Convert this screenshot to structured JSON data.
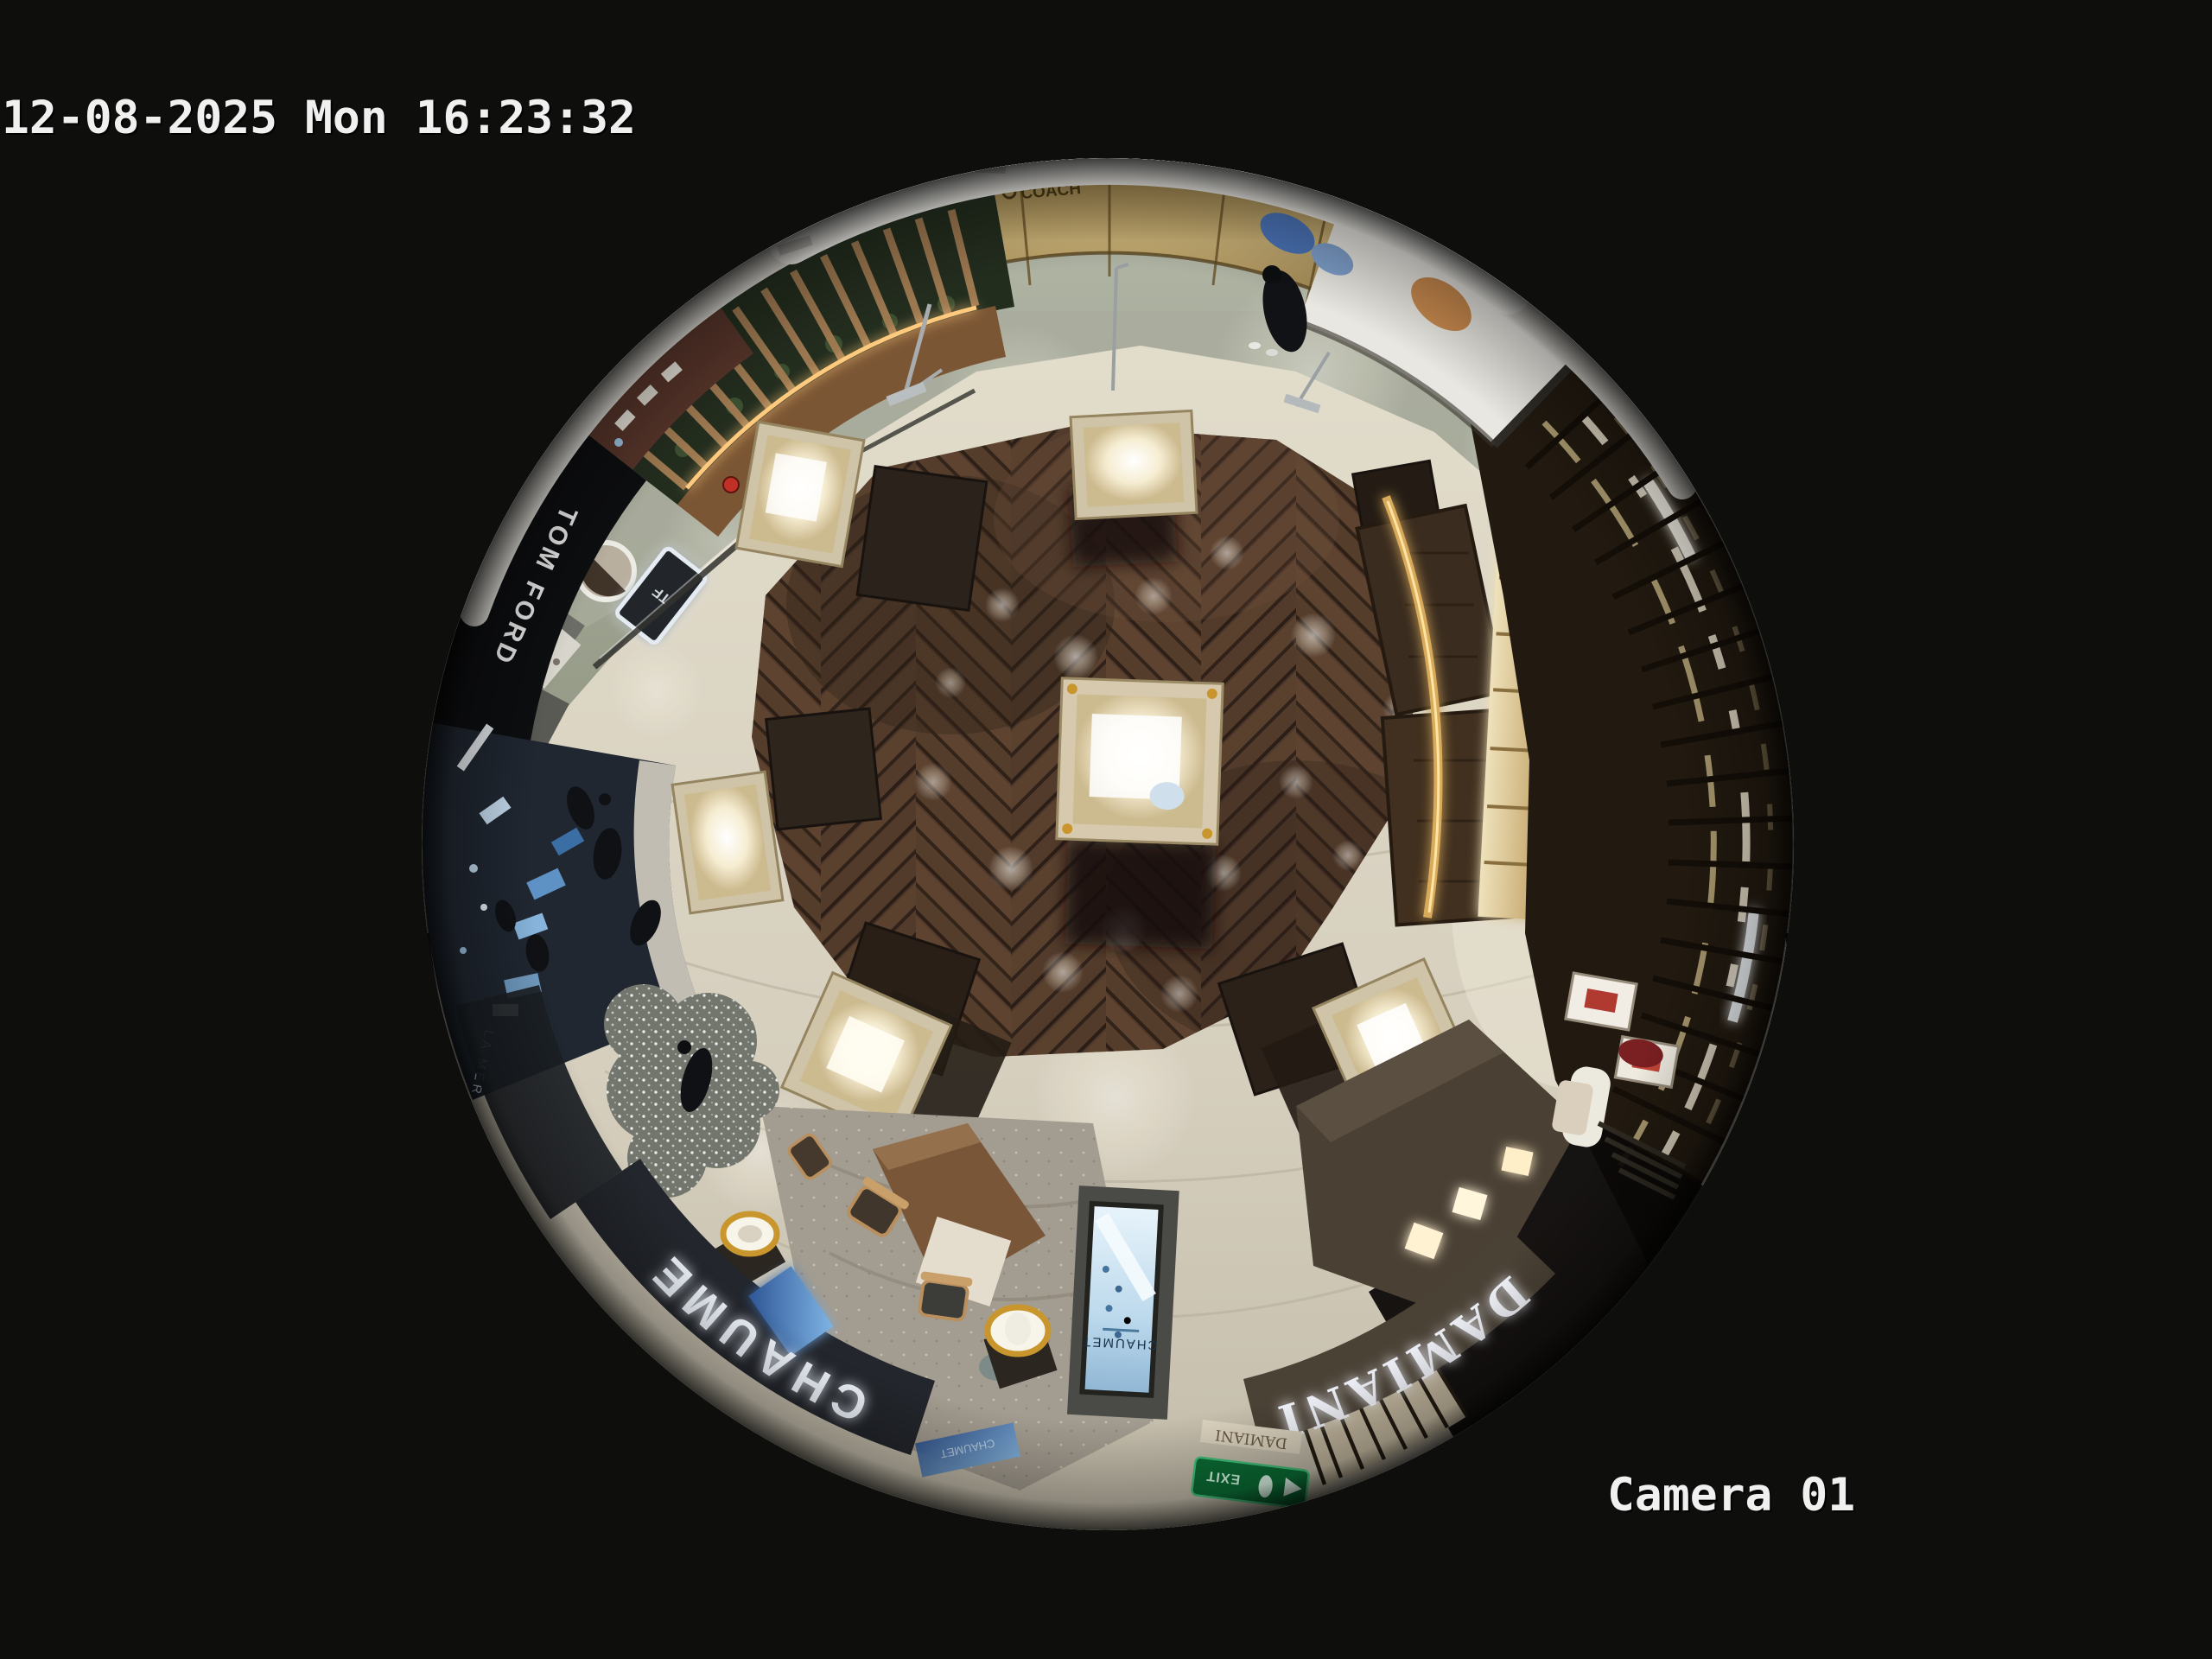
{
  "osd": {
    "timestamp": "12-08-2025 Mon 16:23:32",
    "camera_label": "Camera 01"
  },
  "signs": {
    "chaumet_fascia": "CHAUMET",
    "chaumet_screen": "CHAUMET",
    "chaumet_side_panel": "CHAUMET",
    "damiani_fascia": "DAMIANI",
    "damiani_lintel": "DAMIANI",
    "tom_ford": "TOM FORD",
    "tf_logo": "TF",
    "la_mer": "LA MER",
    "gold_fascia_logo": "COACH",
    "exit_sign": "EXIT"
  },
  "colors": {
    "osd_text": "#f0f0f0",
    "sign_glow_white": "#f2f7ff",
    "chaumet_fascia_bg": "#23262c",
    "damiani_fascia_bg": "#4b4236",
    "exit_green": "#0b6e35",
    "gold_fascia": "#c9b075",
    "wood_floor": "#4a3226",
    "walkway_cream": "#d6cfbe",
    "corridor_marble": "#9aa08d"
  }
}
